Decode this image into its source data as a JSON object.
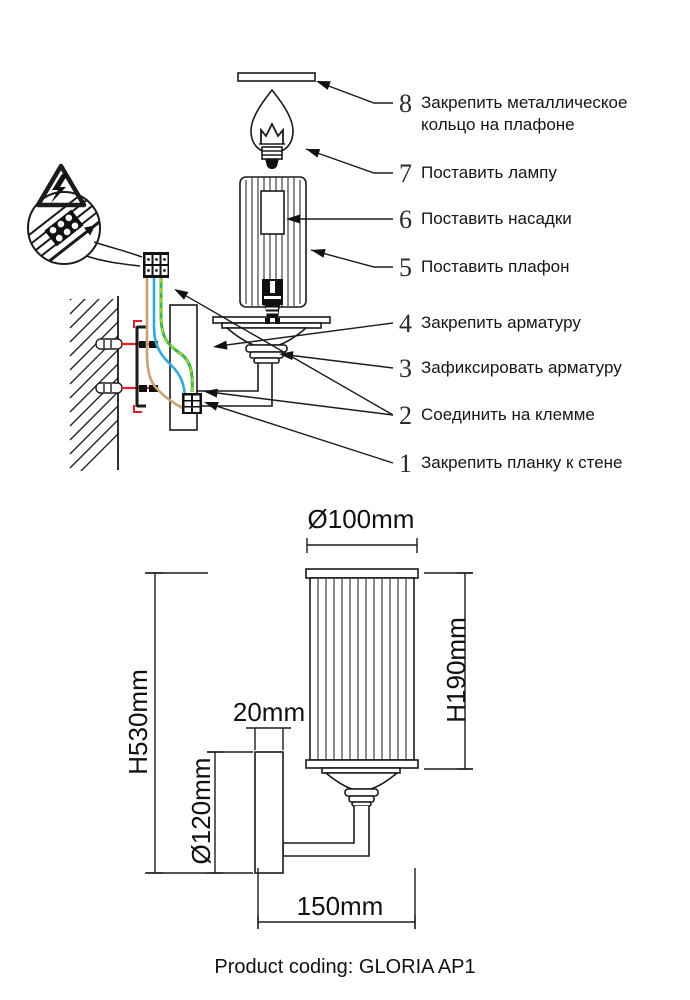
{
  "sheet": {
    "caption": "Product coding: GLORIA AP1"
  },
  "instructions": {
    "steps": [
      {
        "num": "8",
        "text": "Закрепить металлическое кольцо на плафоне"
      },
      {
        "num": "7",
        "text": "Поставить лампу"
      },
      {
        "num": "6",
        "text": "Поставить насадки"
      },
      {
        "num": "5",
        "text": "Поставить плафон"
      },
      {
        "num": "4",
        "text": "Закрепить арматуру"
      },
      {
        "num": "3",
        "text": "Зафиксировать арматуру"
      },
      {
        "num": "2",
        "text": "Соединить на клемме"
      },
      {
        "num": "1",
        "text": "Закрепить планку к стене"
      }
    ]
  },
  "dimensions": {
    "shade_diameter": "Ø100mm",
    "shade_height": "H190mm",
    "overall_height": "H530mm",
    "backplate_height": "Ø120mm",
    "backplate_depth": "20mm",
    "projection": "150mm"
  },
  "colors": {
    "line": "#1b1b1b",
    "screw_red": "#e31e26",
    "wire_brown": "#c9a172",
    "wire_blue": "#2fa9dc",
    "wire_green": "#3cb54a",
    "wire_yellow": "#d9e021"
  }
}
